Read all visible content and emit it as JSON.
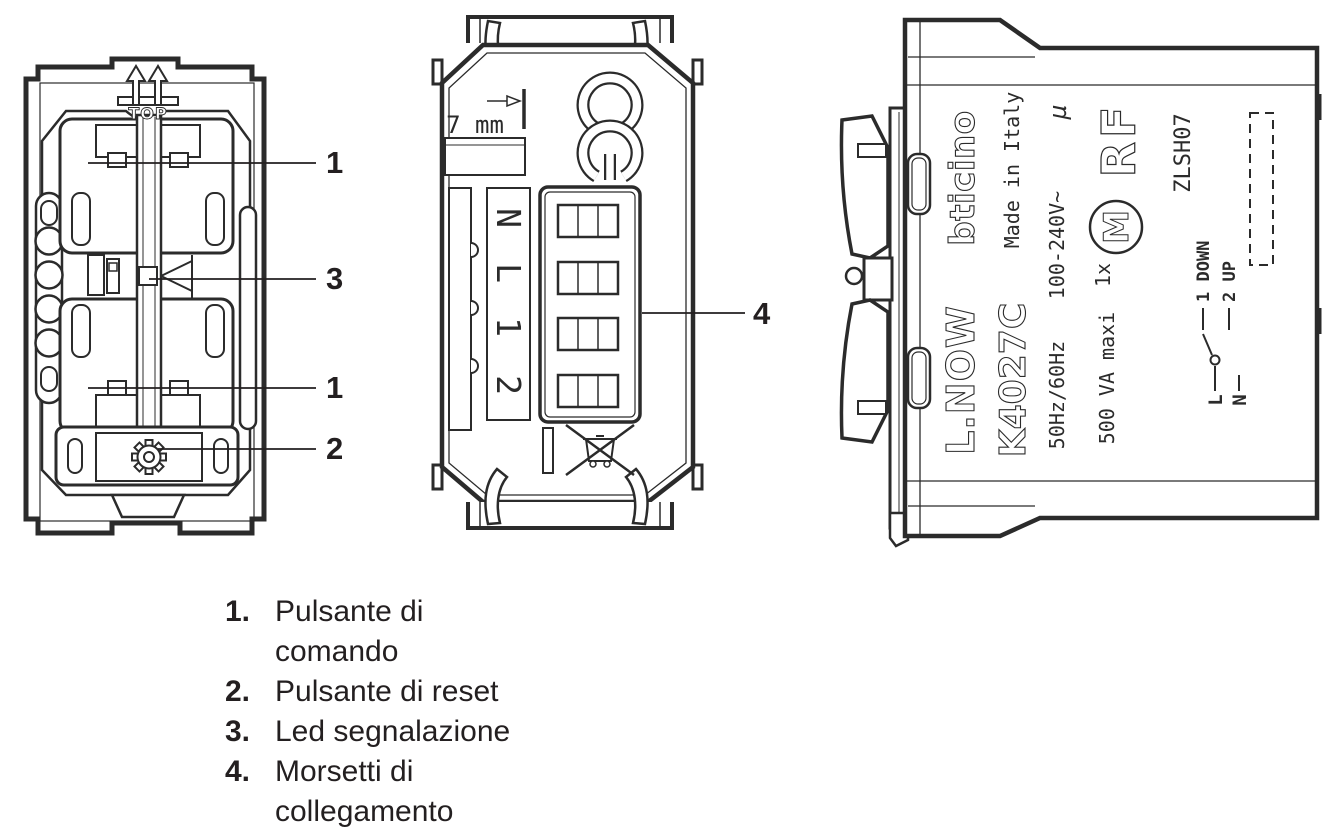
{
  "page": {
    "background": "#ffffff",
    "ink": "#231f20"
  },
  "front_view": {
    "top_label": "TOP",
    "callouts": [
      {
        "label": "1"
      },
      {
        "label": "3"
      },
      {
        "label": "1"
      },
      {
        "label": "2"
      }
    ]
  },
  "rear_view": {
    "gauge_label": "7 mm",
    "terminal_labels": [
      "N",
      "L",
      "1",
      "2"
    ],
    "callout_label": "4"
  },
  "side_view": {
    "series": "L.NOW",
    "brand": "bticino",
    "model": "K4027C",
    "origin": "Made in Italy",
    "frequency": "50Hz/60Hz",
    "voltage": "100-240V~",
    "micro_symbol": "µ",
    "power": "500 VA maxi",
    "motor_count": "1x",
    "motor_mark": "M",
    "radio": "RF",
    "code": "ZLSH07",
    "wiring": {
      "line": "L",
      "neutral": "N",
      "terminal1": "1 DOWN",
      "terminal2": "2 UP"
    }
  },
  "legend": {
    "items": [
      {
        "number": "1.",
        "label": "Pulsante di\ncomando"
      },
      {
        "number": "2.",
        "label": "Pulsante di reset"
      },
      {
        "number": "3.",
        "label": "Led segnalazione"
      },
      {
        "number": "4.",
        "label": "Morsetti di\ncollegamento"
      }
    ]
  }
}
